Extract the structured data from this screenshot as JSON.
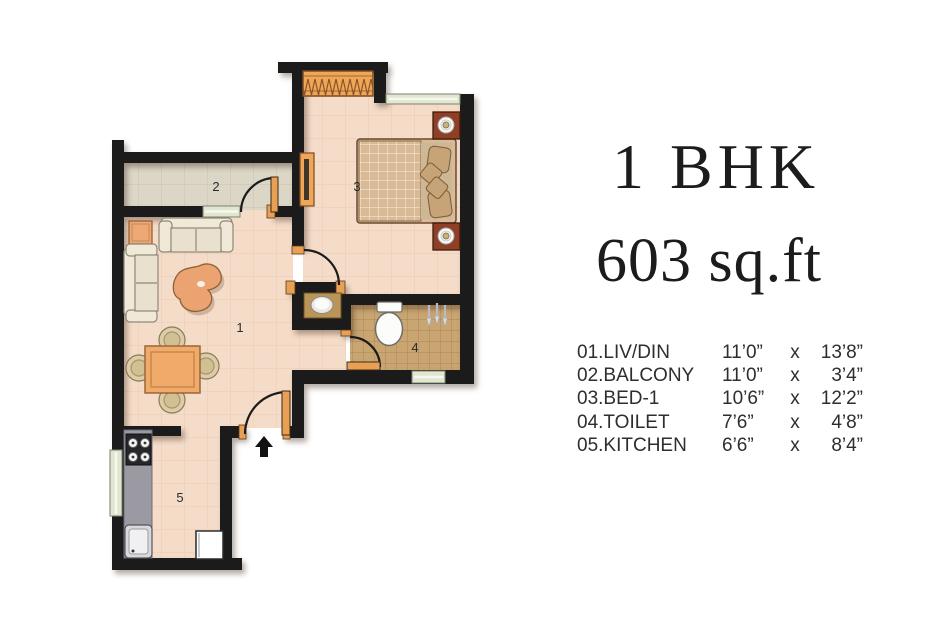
{
  "header": {
    "title": "1 BHK",
    "subtitle": "603 sq.ft"
  },
  "plan": {
    "room_labels": [
      {
        "room": "living-dining",
        "number": "1"
      },
      {
        "room": "balcony",
        "number": "2"
      },
      {
        "room": "bedroom",
        "number": "3"
      },
      {
        "room": "toilet",
        "number": "4"
      },
      {
        "room": "kitchen",
        "number": "5"
      }
    ],
    "entrance": {
      "symbol": "up-arrow",
      "meaning": "main entrance"
    }
  },
  "legend": {
    "rows": [
      {
        "label": "01.LIV/DIN",
        "dim1": "11’0”",
        "sep": "x",
        "dim2": "13’8”"
      },
      {
        "label": "02.BALCONY",
        "dim1": "11’0”",
        "sep": "x",
        "dim2": "3’4”"
      },
      {
        "label": "03.BED-1",
        "dim1": "10’6”",
        "sep": "x",
        "dim2": "12’2”"
      },
      {
        "label": "04.TOILET",
        "dim1": "7’6”",
        "sep": "x",
        "dim2": "4’8”"
      },
      {
        "label": "05.KITCHEN",
        "dim1": "6’6”",
        "sep": "x",
        "dim2": "8’4”"
      }
    ]
  },
  "colors": {
    "wall": "#1b1b1b",
    "floor_living": "#f4dcc8",
    "floor_balcony": "#dcd6c7",
    "floor_toilet": "#c9a572",
    "window": "#e0e6d0",
    "wood_accent": "#eda45f",
    "text": "#1c1c1c"
  }
}
